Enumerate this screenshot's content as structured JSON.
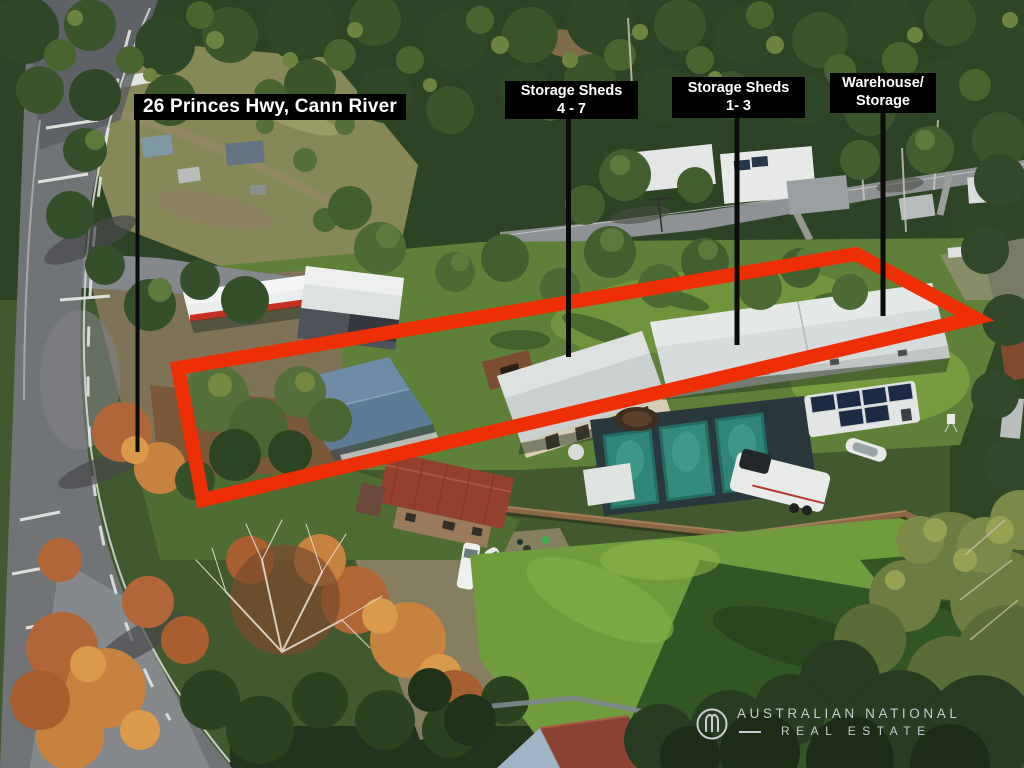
{
  "address_label": {
    "text": "26 Princes Hwy, Cann River"
  },
  "annotation_labels": [
    {
      "line1": "Storage Sheds",
      "line2": "4 - 7"
    },
    {
      "line1": "Storage Sheds",
      "line2": "1- 3"
    },
    {
      "line1": "Warehouse/",
      "line2": "Storage"
    }
  ],
  "boundary": {
    "color": "#ee2e04"
  },
  "label_style": {
    "background": "#000000",
    "text_color": "#ffffff"
  },
  "logo": {
    "line1": "AUSTRALIAN NATIONAL",
    "line2": "REAL ESTATE",
    "color": "#c8cccf"
  }
}
